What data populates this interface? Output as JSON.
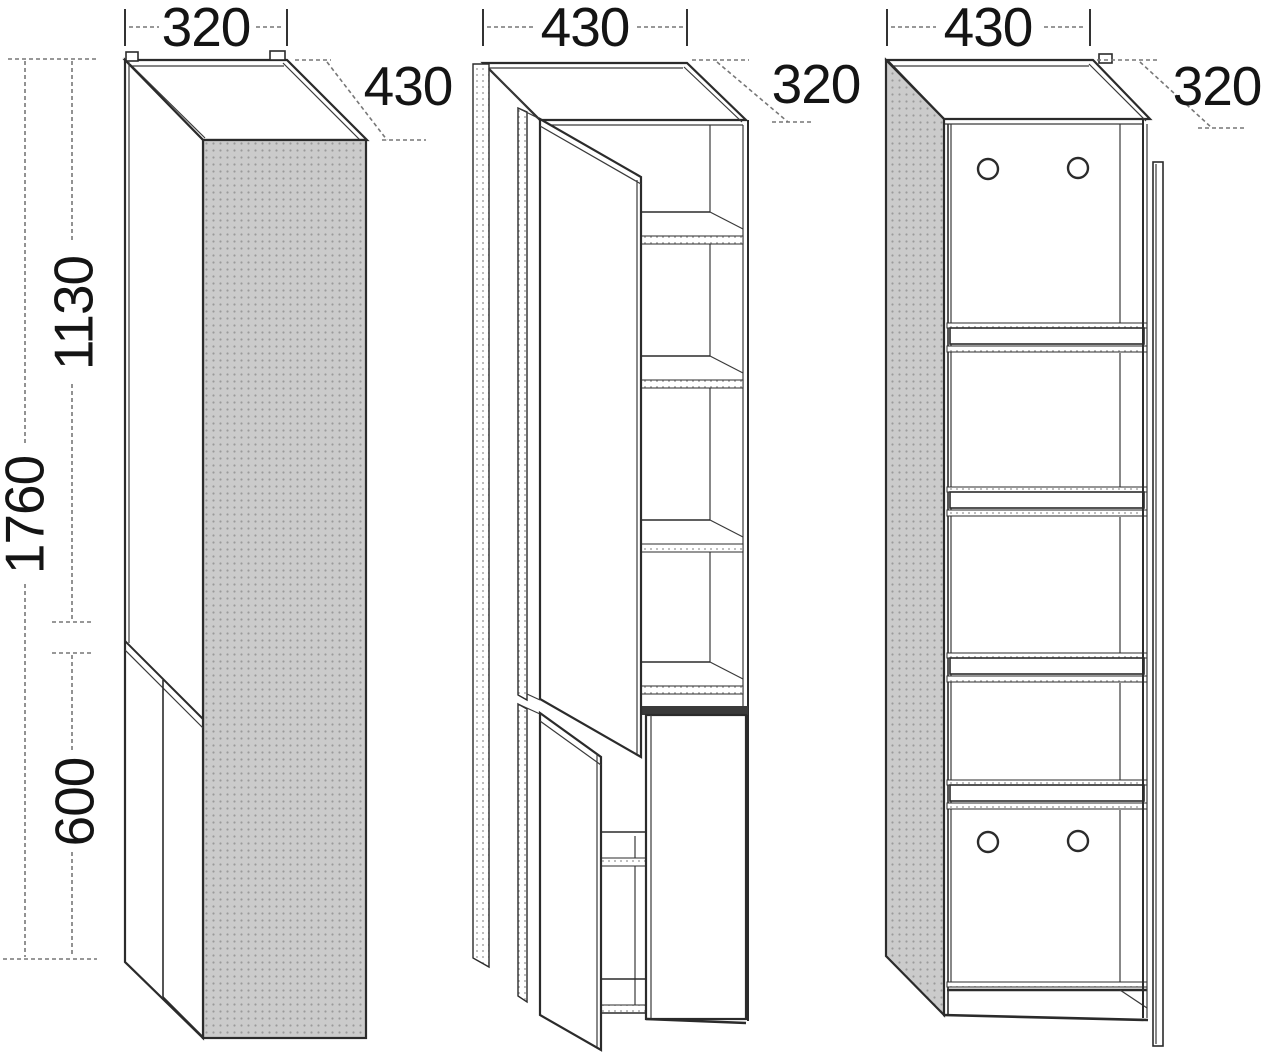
{
  "views": {
    "left": {
      "width": "320",
      "depth": "430",
      "height_total": "1760",
      "height_upper": "1130",
      "height_lower": "600"
    },
    "middle": {
      "width": "430",
      "depth": "320"
    },
    "right": {
      "width": "430",
      "depth": "320"
    }
  },
  "colors": {
    "line": "#2b2b2b",
    "dim_line": "#777777",
    "text": "#141414",
    "panel_fill": "#cbcbcb",
    "panel_dot": "#9a9a9a",
    "background": "#ffffff"
  }
}
